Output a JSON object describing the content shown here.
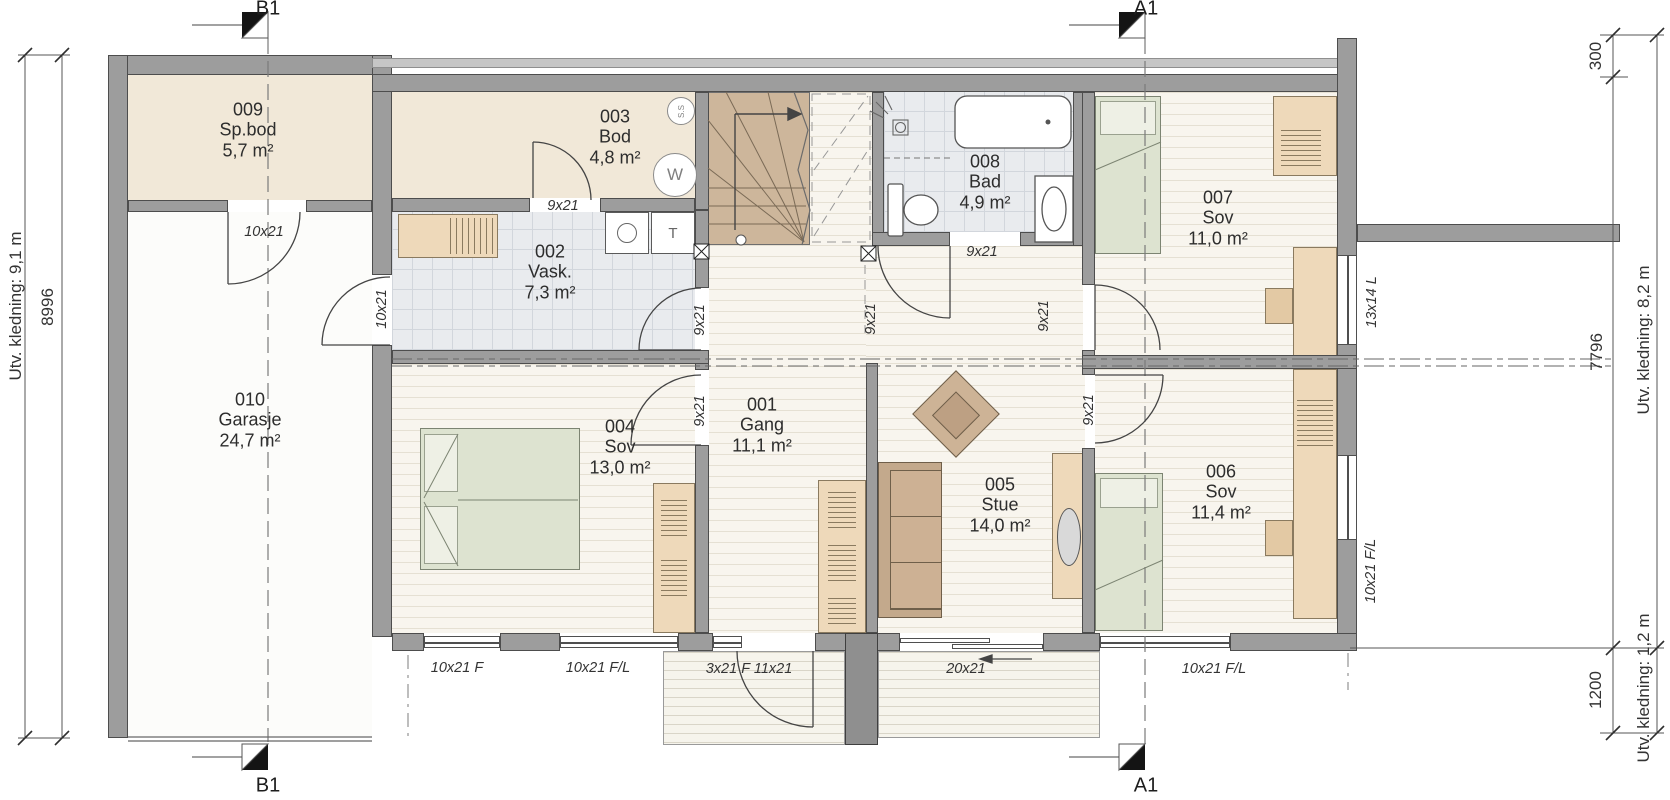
{
  "drawing": {
    "type": "floor-plan",
    "section_markers": {
      "b1": "B1",
      "a1": "A1"
    },
    "rooms": [
      {
        "number": "001",
        "name": "Gang",
        "area": "11,1 m²"
      },
      {
        "number": "002",
        "name": "Vask.",
        "area": "7,3 m²"
      },
      {
        "number": "003",
        "name": "Bod",
        "area": "4,8 m²"
      },
      {
        "number": "004",
        "name": "Sov",
        "area": "13,0 m²"
      },
      {
        "number": "005",
        "name": "Stue",
        "area": "14,0 m²"
      },
      {
        "number": "006",
        "name": "Sov",
        "area": "11,4 m²"
      },
      {
        "number": "007",
        "name": "Sov",
        "area": "11,0 m²"
      },
      {
        "number": "008",
        "name": "Bad",
        "area": "4,9 m²"
      },
      {
        "number": "009",
        "name": "Sp.bod",
        "area": "5,7 m²"
      },
      {
        "number": "010",
        "name": "Garasje",
        "area": "24,7 m²"
      }
    ],
    "opening_labels": {
      "spbod_door": "10x21",
      "garage_door": "10x21",
      "bod_door": "9x21",
      "vask_door": "9x21",
      "sov004_door": "9x21",
      "bad_door": "9x21",
      "hall_door": "9x21",
      "sov007_door": "9x21",
      "sov006_door": "9x21",
      "window_13x14": "13x14 L",
      "window_right_006": "10x21 F/L",
      "window_004_a": "10x21 F",
      "window_004_b": "10x21 F/L",
      "entry_door": "3x21 F 11x21",
      "slide_door": "20x21",
      "window_006_bottom": "10x21 F/L"
    },
    "dimensions": {
      "left_outer": "Utv. kledning: 9,1 m",
      "left_inner": "8996",
      "right_top": "300",
      "right_middle": "7796",
      "right_bottom": "1200",
      "right_outer_upper": "Utv. kledning: 8,2 m",
      "right_outer_lower": "Utv. kledning: 1,2 m"
    },
    "fixtures": {
      "water_heater": "W",
      "suction_outlet": "S.S",
      "dryer": "T",
      "electrical": "↯"
    },
    "colors": {
      "wall": "#9d9d9d",
      "storage_floor": "#f1e8d8",
      "wet_room_floor": "#e9ebee",
      "wood_floor": "#f8f5ee",
      "stair": "#cdb69b",
      "furniture_wood": "#eed9ba",
      "bed_green": "#dde3d0",
      "sofa": "#c3a98c"
    }
  }
}
